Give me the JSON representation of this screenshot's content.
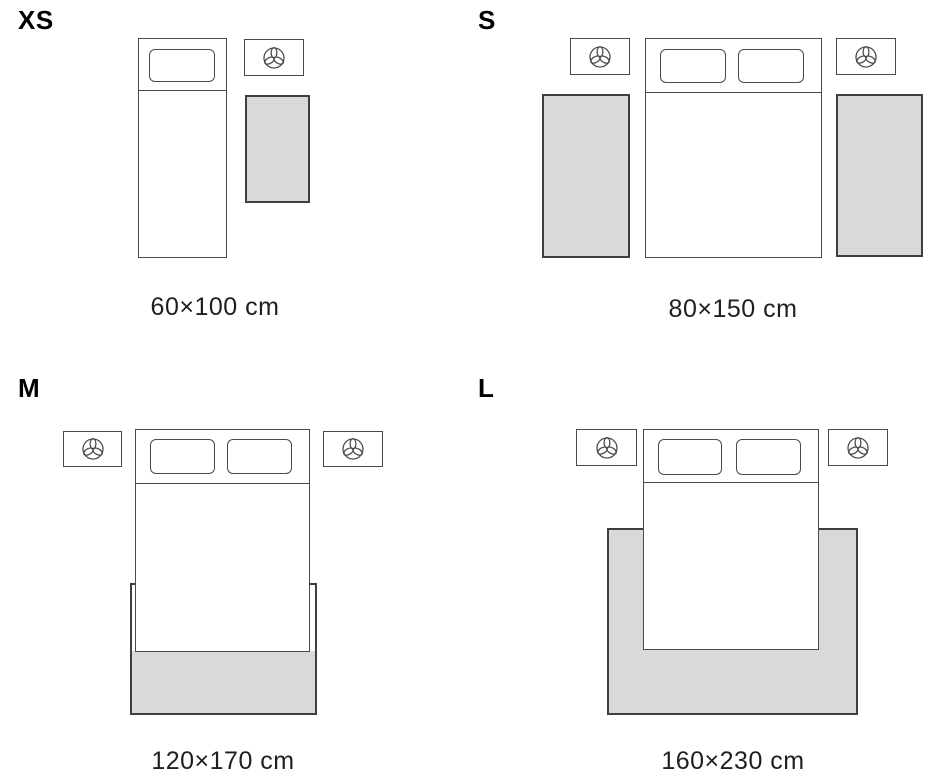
{
  "title": "Rug size guide bedroom layout diagram",
  "colors": {
    "outline": "#4a4a4a",
    "rug_outline": "#3f3f3f",
    "rug_fill": "#d9d9d9",
    "text": "#1f1f1f",
    "label": "#000000",
    "background": "#ffffff"
  },
  "sizes": [
    {
      "id": "xs",
      "label": "XS",
      "dimensions": "60×100 cm",
      "layout": "single bed with one nightstand and one rug beside the bed"
    },
    {
      "id": "s",
      "label": "S",
      "dimensions": "80×150 cm",
      "layout": "double bed with two nightstands and a runner rug on each side"
    },
    {
      "id": "m",
      "label": "M",
      "dimensions": "120×170 cm",
      "layout": "double bed with two nightstands, rug under the lower third of the bed"
    },
    {
      "id": "l",
      "label": "L",
      "dimensions": "160×230 cm",
      "layout": "double bed with two nightstands, large rug extending around the lower half of the bed"
    }
  ],
  "icons": {
    "nightstand_icon": "plant-icon"
  }
}
